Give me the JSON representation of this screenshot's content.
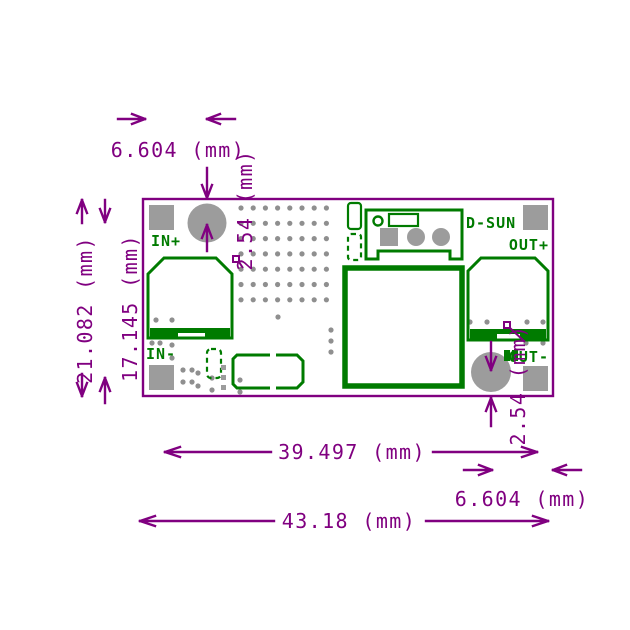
{
  "title": "DC-DC converter module PCB dimension drawing",
  "colors": {
    "dimension": "#800080",
    "silkscreen": "#007b00",
    "pad": "#9c9c9c",
    "via": "#8f8f8f"
  },
  "board": {
    "labels": {
      "in_plus": "IN+",
      "in_minus": "IN-",
      "out_plus": "OUT+",
      "out_minus": "OUT-",
      "brand": "D-SUN"
    }
  },
  "dims": {
    "top_pad_inset": "6.604 (mm)",
    "board_height": "21.082 (mm)",
    "pad_row_span": "17.145 (mm)",
    "top_pad_offset": "2.54 (mm)",
    "pad_span_width": "39.497 (mm)",
    "bottom_pad_inset": "6.604 (mm)",
    "board_width": "43.18 (mm)",
    "bottom_pad_offset": "2.54 (mm)"
  },
  "vias": {
    "grid": {
      "x0": 241,
      "y0": 208,
      "dx": 12.2,
      "dy": 15.3,
      "cols": 8,
      "rows": 7
    },
    "extra": [
      [
        278,
        317
      ],
      [
        331,
        330
      ],
      [
        331,
        341
      ],
      [
        331,
        352
      ],
      [
        156,
        320
      ],
      [
        172,
        320
      ],
      [
        152,
        343
      ],
      [
        160,
        343
      ],
      [
        172,
        345
      ],
      [
        172,
        358
      ],
      [
        183,
        370
      ],
      [
        192,
        370
      ],
      [
        183,
        382
      ],
      [
        192,
        382
      ],
      [
        198,
        373
      ],
      [
        198,
        386
      ],
      [
        212,
        378
      ],
      [
        212,
        390
      ],
      [
        240,
        380
      ],
      [
        240,
        392
      ],
      [
        470,
        322
      ],
      [
        487,
        322
      ],
      [
        527,
        322
      ],
      [
        543,
        322
      ],
      [
        526,
        343
      ],
      [
        543,
        343
      ]
    ]
  }
}
